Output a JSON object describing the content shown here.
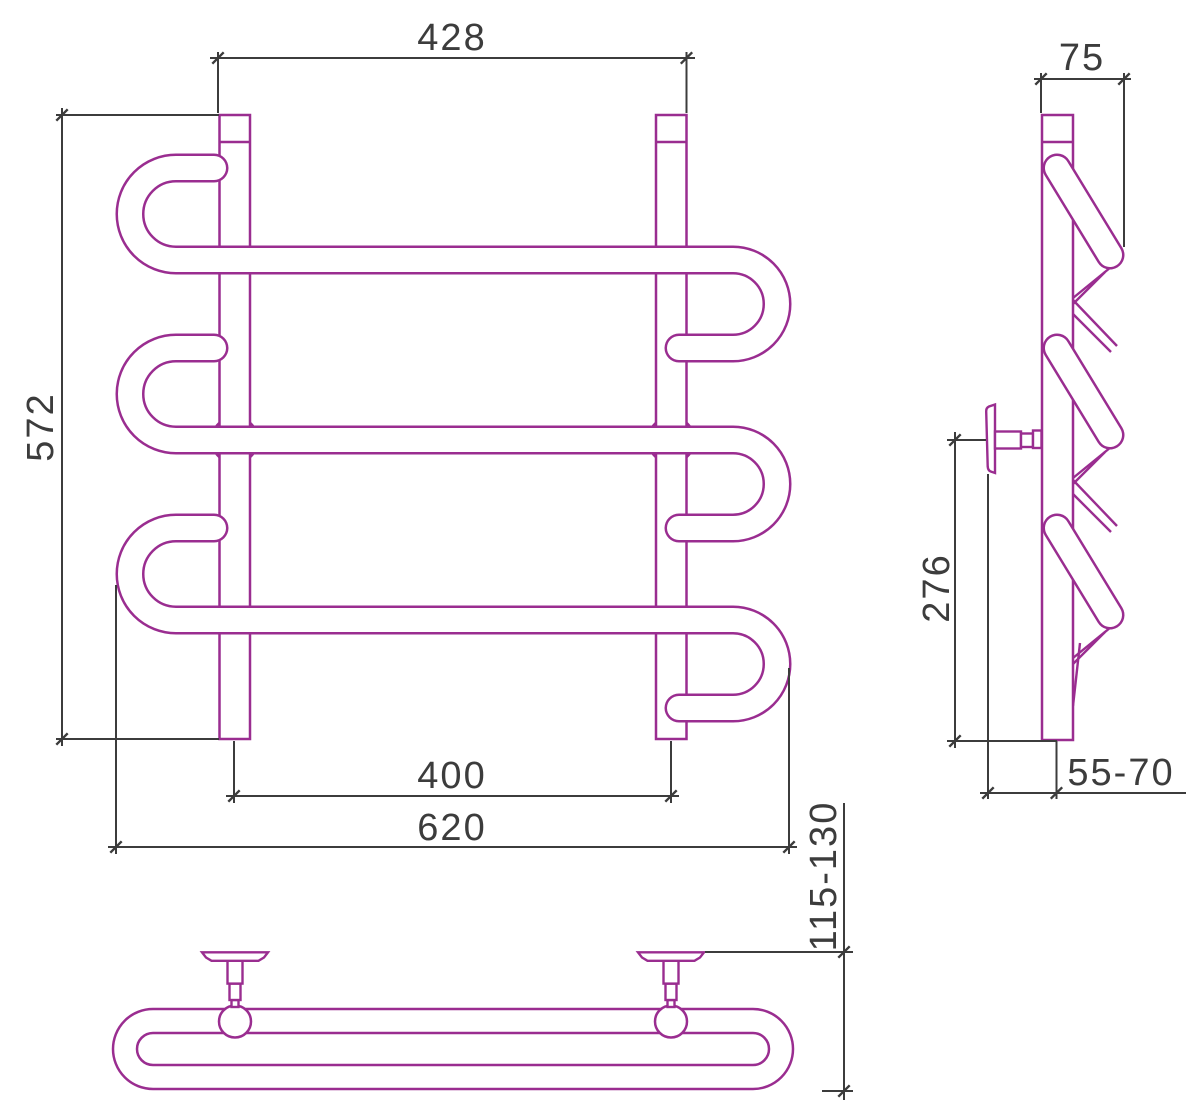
{
  "canvas": {
    "width": "1200",
    "height": "1112",
    "background": "#ffffff"
  },
  "palette": {
    "part_outline": "#9a2d90",
    "dimension_line": "#3c3c3c",
    "text": "#3c3c3c"
  },
  "views": {
    "front": {
      "dim_top_width": "428",
      "dim_height": "572",
      "dim_rail_centers": "400",
      "dim_overall_width": "620",
      "dim_wall_offset": "115-130"
    },
    "side": {
      "dim_depth": "75",
      "dim_bracket_to_bottom": "276",
      "dim_bracket_depth": "55-70"
    }
  }
}
